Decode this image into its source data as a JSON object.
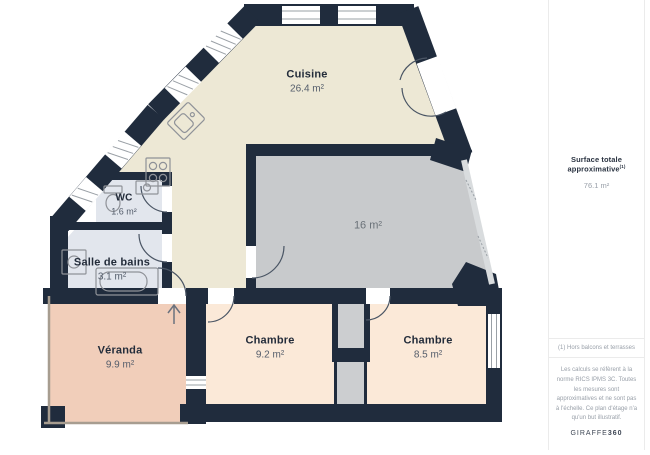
{
  "plan": {
    "rooms": [
      {
        "name": "Cuisine",
        "area": "26.4 m²"
      },
      {
        "name": "WC",
        "area": "1.6 m²"
      },
      {
        "name": "Salle de bains",
        "area": "3.1 m²"
      },
      {
        "name": "",
        "area": "16 m²"
      },
      {
        "name": "Véranda",
        "area": "9.9 m²"
      },
      {
        "name": "Chambre",
        "area": "9.2 m²"
      },
      {
        "name": "Chambre",
        "area": "8.5 m²"
      }
    ],
    "icons": {
      "entrance-arrow": "↑"
    }
  },
  "sidebar": {
    "total_label": "Surface totale approximative",
    "total_superscript": "(1)",
    "total_value": "76.1 m²",
    "footnote": "(1) Hors balcons et terrasses",
    "disclaimer": "Les calculs se réfèrent à la norme RICS IPMS 3C. Toutes les mesures sont approximatives et ne sont pas à l'échelle. Ce plan d'étage n'a qu'un but illustratif.",
    "brand": {
      "name": "GIRAFFE",
      "suffix": "360"
    }
  },
  "colors": {
    "wall": "#202C3D",
    "floor-cuisine": "#EDE8D5",
    "floor-room16": "#C8CACC",
    "floor-bain": "#E2E6ED",
    "floor-veranda": "#F1CEBA",
    "floor-chambre": "#FBE9D8",
    "floor-shaft": "#CCCED0",
    "window-line": "#9AA0A6",
    "arc": "#4A5564",
    "fixture": "#8F9298",
    "thin-wall": "#A79D90",
    "text-dark": "#232C3A",
    "text-gray": "#545D6B",
    "divider": "#EBEBEB",
    "sb-title": "#2B3442",
    "sb-gray": "#989FA8",
    "brand": "#3E4654"
  }
}
